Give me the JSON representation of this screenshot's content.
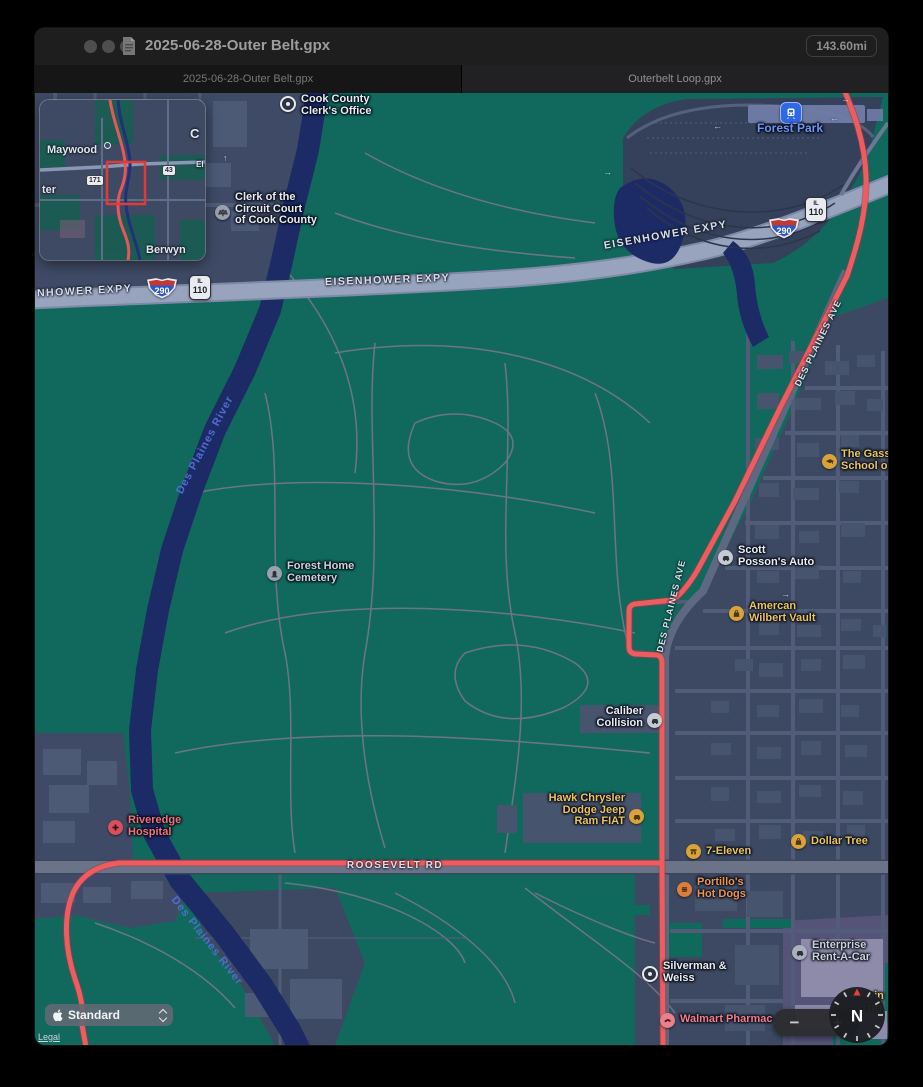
{
  "titlebar": {
    "title": "2025-06-28-Outer Belt.gpx",
    "distance_badge": "143.60mi"
  },
  "tabs": {
    "tab1": "2025-06-28-Outer Belt.gpx",
    "tab2": "Outerbelt Loop.gpx"
  },
  "inset": {
    "maywood": "Maywood",
    "ter_partial": "ter",
    "berwyn": "Berwyn",
    "chicago_partial": "C",
    "ei_partial": "EI",
    "shield_171": "171",
    "shield_43": "43"
  },
  "roads": {
    "eisenhower_left_partial": "NHOWER EXPY",
    "eisenhower_center": "EISENHOWER EXPY",
    "eisenhower_right": "EISENHOWER EXPY",
    "roosevelt": "ROOSEVELT RD",
    "des_plaines_ave": "DES PLAINES AVE",
    "i290": "290",
    "il110_l1": "IL",
    "il110_l2": "110",
    "berwyn_city": "Berwyn"
  },
  "water": {
    "river_label": "Des Plaines River"
  },
  "pois": {
    "cook_clerk": {
      "l1": "Cook County",
      "l2": "Clerk's Office"
    },
    "circuit_court": {
      "l1": "Clerk of the",
      "l2": "Circuit Court",
      "l3": "of Cook County"
    },
    "forest_park": {
      "l1": "Forest Park"
    },
    "gass_school": {
      "l1": "The Gass",
      "l2": "School o"
    },
    "scott_posson": {
      "l1": "Scott",
      "l2": "Posson's Auto"
    },
    "wilbert": {
      "l1": "Amercan",
      "l2": "Wilbert Vault"
    },
    "forest_home": {
      "l1": "Forest Home",
      "l2": "Cemetery"
    },
    "caliber": {
      "l1": "Caliber",
      "l2": "Collision"
    },
    "hawk": {
      "l1": "Hawk Chrysler",
      "l2": "Dodge Jeep",
      "l3": "Ram FIAT"
    },
    "seven_eleven": {
      "l1": "7-Eleven"
    },
    "dollar_tree": {
      "l1": "Dollar Tree"
    },
    "riveredge": {
      "l1": "Riveredge",
      "l2": "Hospital"
    },
    "portillos": {
      "l1": "Portillo's",
      "l2": "Hot Dogs"
    },
    "enterprise": {
      "l1": "Enterprise",
      "l2": "Rent-A-Car"
    },
    "silverman": {
      "l1": "Silverman &",
      "l2": "Weiss"
    },
    "walmart": {
      "l1": "Walmart Pharmac"
    },
    "clipped_right": {
      "l1": "vin",
      "l2": "nri"
    }
  },
  "icons": {
    "arrow_right": "→",
    "arrow_left": "←",
    "arrow_up": "↑"
  },
  "controls": {
    "map_type": "Standard",
    "legal": "Legal",
    "zoom_out": "−",
    "zoom_in": "+",
    "compass_n": "N"
  },
  "colors": {
    "route_red": "#ee5c60",
    "cemetery_green": "#11695d",
    "water_blue": "#1c2b66",
    "urban_slate": "#3d4962",
    "highway_gray": "#98a4be",
    "poi_yellow": "#ecc45e",
    "poi_orange": "#eb9450",
    "poi_red": "#f0717c",
    "transit_blue": "#2f68e8"
  }
}
